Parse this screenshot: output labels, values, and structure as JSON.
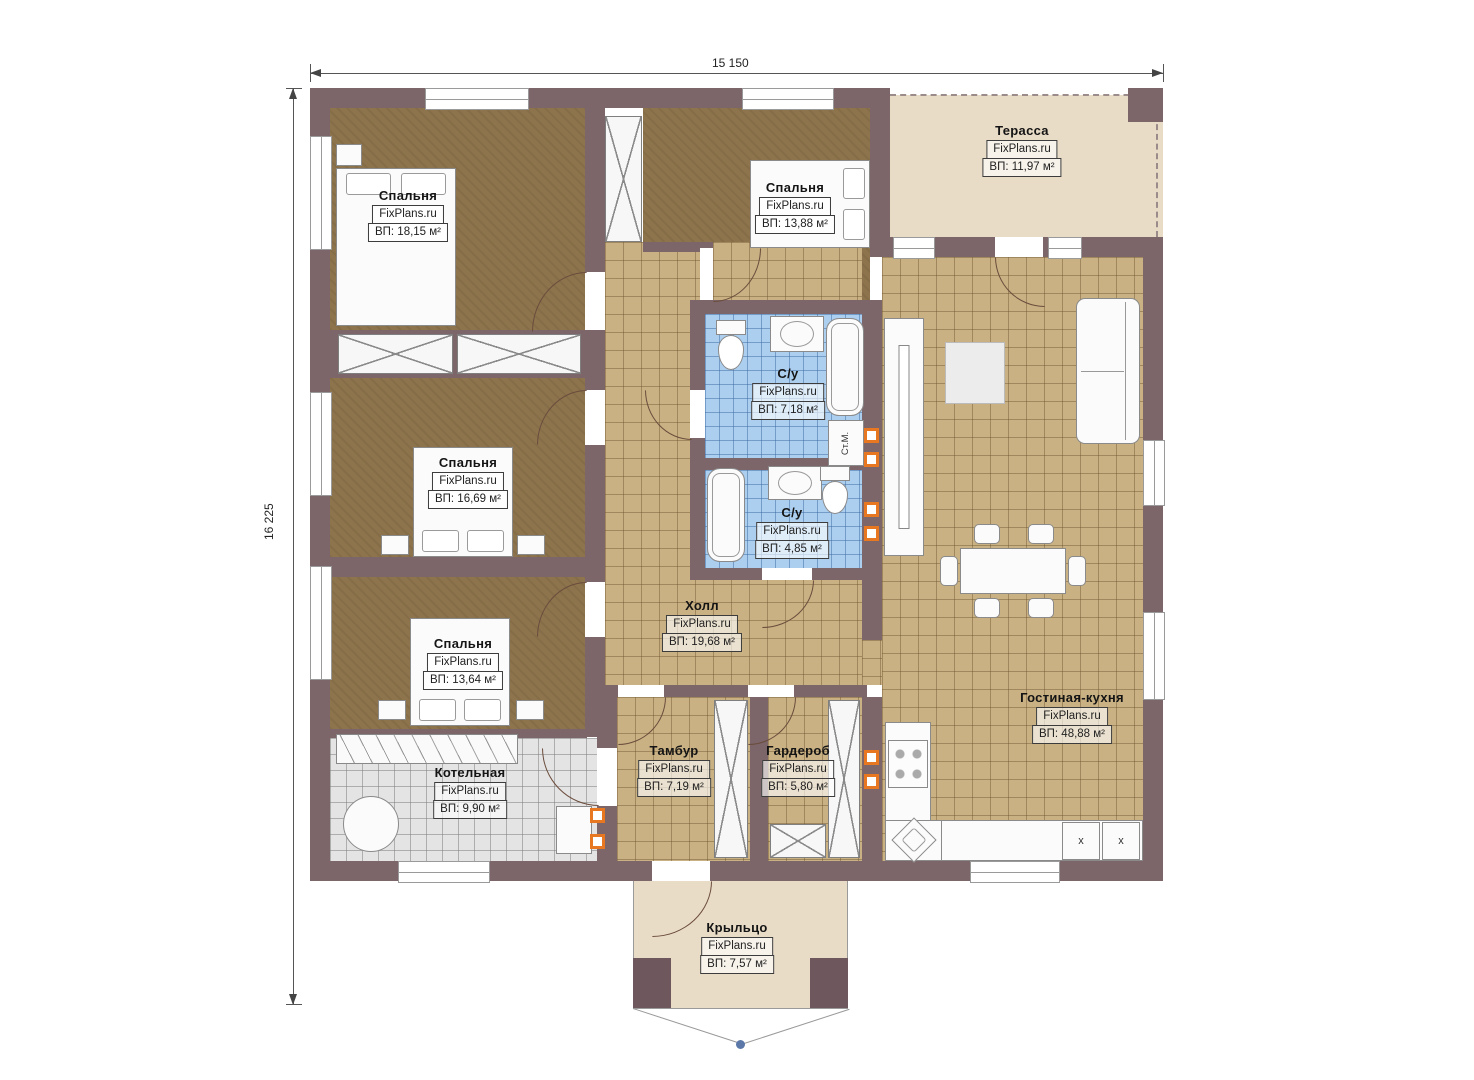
{
  "plan": {
    "dimensions": {
      "width": "15 150",
      "height": "16 225"
    },
    "watermark": "FixPlans.ru",
    "rooms": {
      "bedroom_tl": {
        "name": "Спальня",
        "area": "ВП: 18,15 м²"
      },
      "bedroom_top": {
        "name": "Спальня",
        "area": "ВП: 13,88 м²"
      },
      "terrace": {
        "name": "Терасса",
        "area": "ВП: 11,97 м²"
      },
      "bedroom_ml": {
        "name": "Спальня",
        "area": "ВП: 16,69 м²"
      },
      "bathroom_top": {
        "name": "С/у",
        "area": "ВП: 7,18 м²"
      },
      "bathroom_bottom": {
        "name": "С/у",
        "area": "ВП: 4,85 м²"
      },
      "bedroom_bl": {
        "name": "Спальня",
        "area": "ВП: 13,64 м²"
      },
      "hall": {
        "name": "Холл",
        "area": "ВП: 19,68 м²"
      },
      "boiler_room": {
        "name": "Котельная",
        "area": "ВП: 9,90 м²"
      },
      "tambour": {
        "name": "Тамбур",
        "area": "ВП: 7,19 м²"
      },
      "wardrobe_room": {
        "name": "Гардероб",
        "area": "ВП: 5,80 м²"
      },
      "living_kitchen": {
        "name": "Гостиная-кухня",
        "area": "ВП: 48,88 м²"
      },
      "porch": {
        "name": "Крыльцо",
        "area": "ВП: 7,57 м²"
      }
    },
    "annotations": {
      "washing_machine": "Ст.М.",
      "appliance_mark_1": "x",
      "appliance_mark_2": "x"
    }
  },
  "colors": {
    "wall": "#7c666a",
    "bedroom_floor": "#8d744d",
    "tile_floor": "#c9b183",
    "bath_floor": "#accff0",
    "boiler_floor": "#e4e4e4",
    "terrace_floor": "#e9dcc7",
    "marker_orange": "#e87722",
    "arc": "#6b4c3c"
  }
}
